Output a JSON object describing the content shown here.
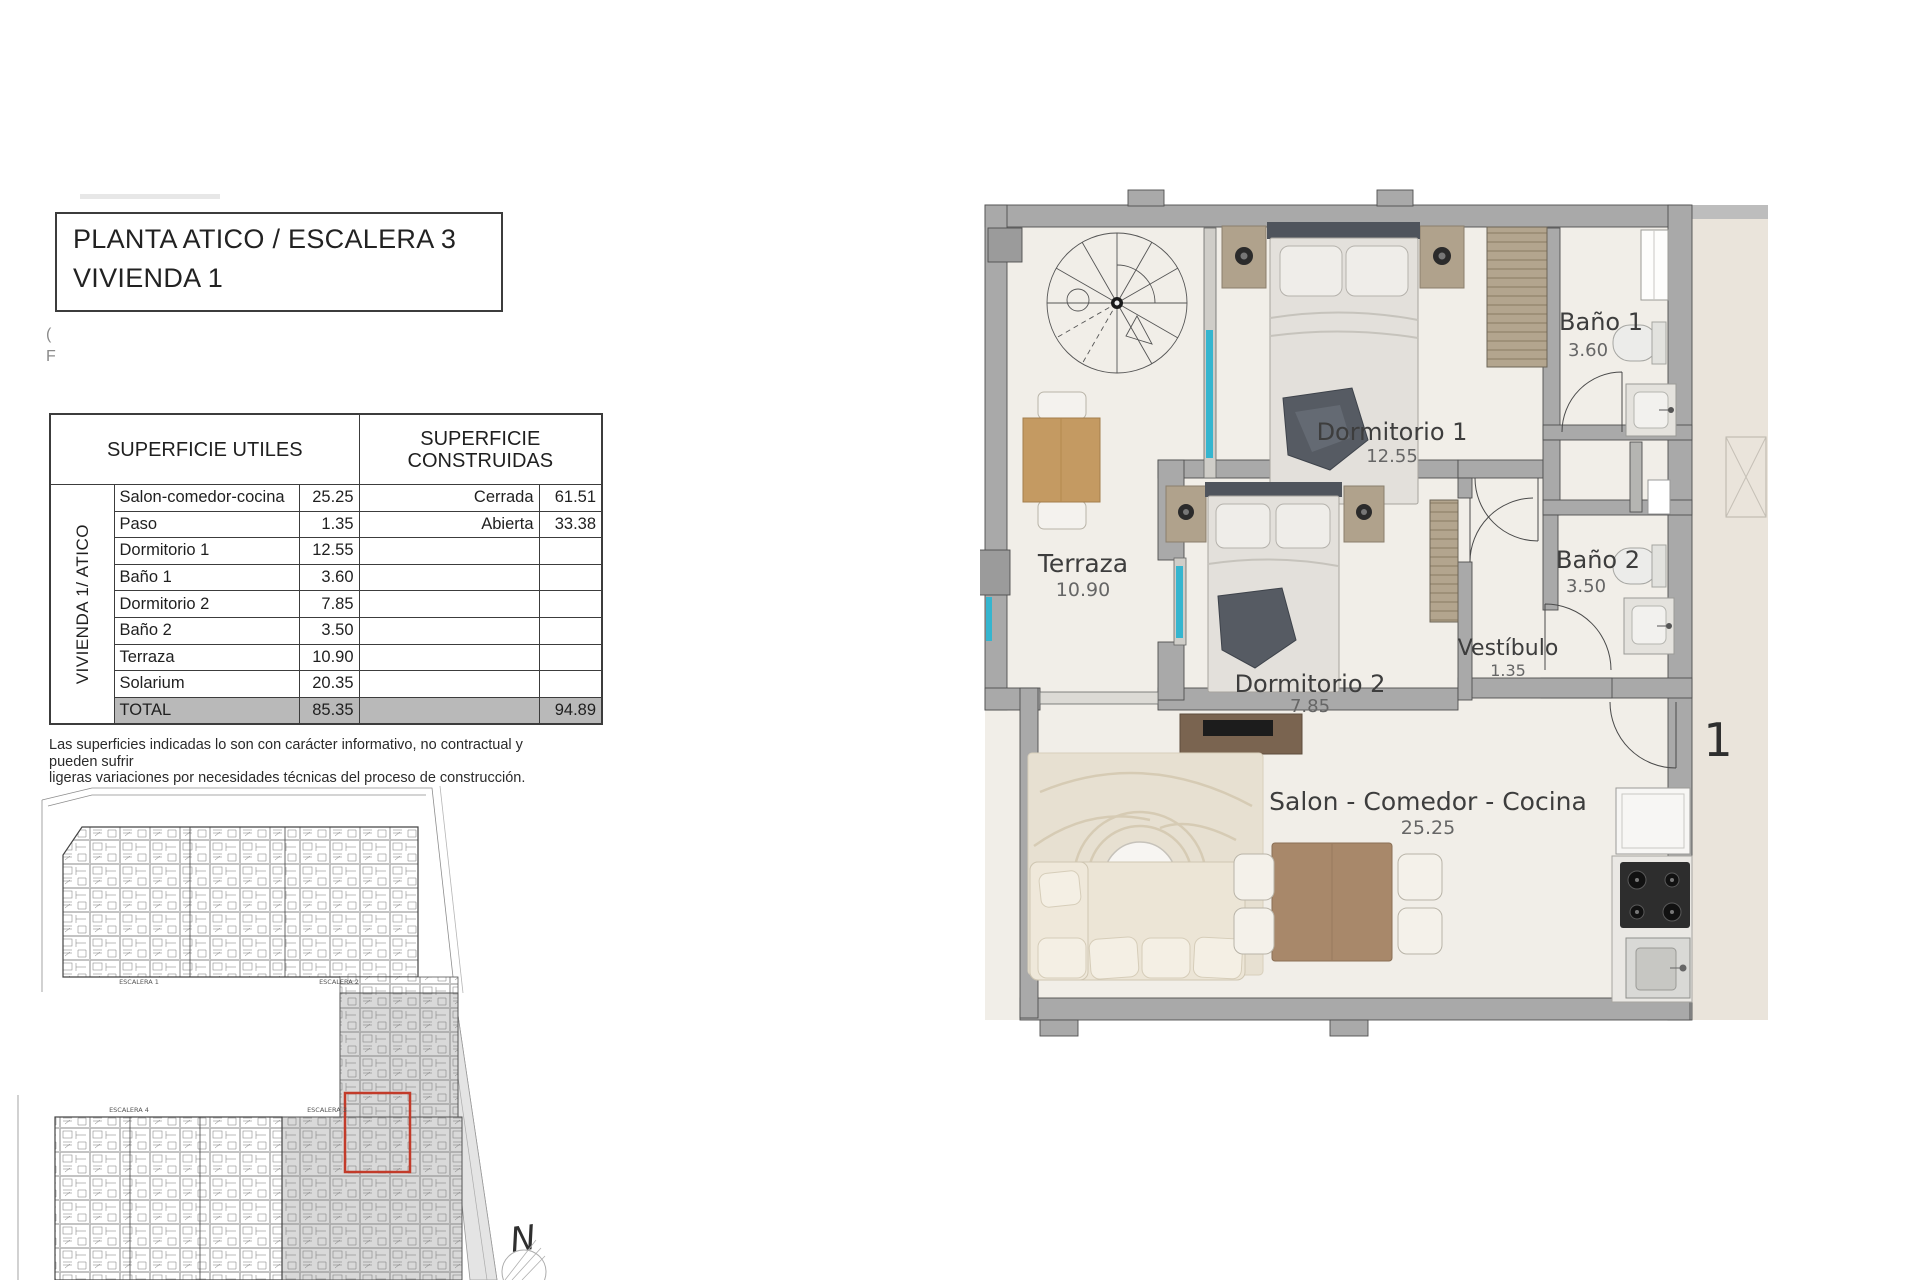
{
  "title_block": {
    "line1": "PLANTA ATICO / ESCALERA 3",
    "line2": "VIVIENDA 1"
  },
  "margin_marks": {
    "mark1": "(",
    "mark2": "F"
  },
  "areas_table": {
    "header_utiles": "SUPERFICIE UTILES",
    "header_construidas_1": "SUPERFICIE",
    "header_construidas_2": "CONSTRUIDAS",
    "side_label": "VIVIENDA 1/ ATICO",
    "rows": [
      {
        "name": "Salon-comedor-cocina",
        "value": "25.25",
        "clabel": "Cerrada",
        "cvalue": "61.51"
      },
      {
        "name": "Paso",
        "value": "1.35",
        "clabel": "Abierta",
        "cvalue": "33.38"
      },
      {
        "name": "Dormitorio 1",
        "value": "12.55",
        "clabel": "",
        "cvalue": ""
      },
      {
        "name": "Baño 1",
        "value": "3.60",
        "clabel": "",
        "cvalue": ""
      },
      {
        "name": "Dormitorio 2",
        "value": "7.85",
        "clabel": "",
        "cvalue": ""
      },
      {
        "name": "Baño 2",
        "value": "3.50",
        "clabel": "",
        "cvalue": ""
      },
      {
        "name": "Terraza",
        "value": "10.90",
        "clabel": "",
        "cvalue": ""
      },
      {
        "name": "Solarium",
        "value": "20.35",
        "clabel": "",
        "cvalue": ""
      }
    ],
    "total_label": "TOTAL",
    "total_value": "85.35",
    "total_cvalue": "94.89"
  },
  "disclaimer": {
    "line1": "Las superficies indicadas lo son con carácter informativo, no contractual y pueden sufrir",
    "line2": "ligeras variaciones por necesidades técnicas del proceso de construcción."
  },
  "floor_plan": {
    "terraza_name": "Terraza",
    "terraza_area": "10.90",
    "dorm1_name": "Dormitorio 1",
    "dorm1_area": "12.55",
    "bano1_name": "Baño 1",
    "bano1_area": "3.60",
    "bano2_name": "Baño 2",
    "bano2_area": "3.50",
    "vestibulo_name": "Vestíbulo",
    "vestibulo_area": "1.35",
    "dorm2_name": "Dormitorio 2",
    "dorm2_area": "7.85",
    "salon_name": "Salon - Comedor - Cocina",
    "salon_area": "25.25",
    "unit_number": "1",
    "colors": {
      "window": "#35b5cf",
      "wall": "#a9a9a9",
      "floor": "#f1eee8"
    }
  },
  "site_plan": {
    "escalera1": "ESCALERA 1",
    "escalera2": "ESCALERA 2",
    "escalera3": "ESCALERA 3",
    "escalera4": "ESCALERA 4",
    "north_letter": "N",
    "highlight_color": "#c23b2a"
  }
}
